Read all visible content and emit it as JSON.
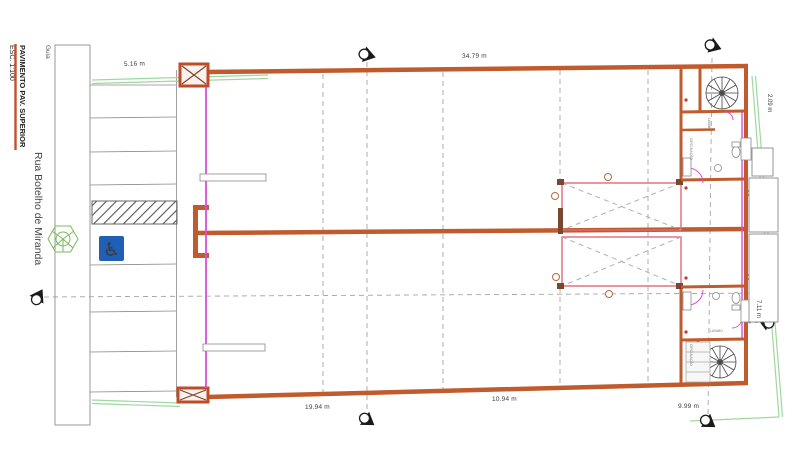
{
  "drawing": {
    "title": "PAVIMENTO PAV. SUPERIOR",
    "scale": "ESC. 1:100",
    "street_name": "Rua Botelho de Miranda",
    "curb_label": "Guia"
  },
  "dimensions": {
    "front_setback": "5.16 m",
    "top_width": "34.79 m",
    "right_setback": "2.09 m",
    "bottom_left_width": "19.94 m",
    "bottom_middle_width": "10.94 m",
    "bottom_right_width": "9.99 m",
    "right_depth": "7.11 m"
  },
  "rooms": {
    "lavabo_upper": "LAVABO",
    "circulation_upper": "CIRCULAÇÃO",
    "lavabo_lower": "LAVABO",
    "circulation_lower": "CIRCULAÇÃO"
  },
  "colors": {
    "wall": "#bf5b2c",
    "boundary_green": "#9fd89f",
    "glass_magenta": "#d94fd9",
    "void_outline": "#e0697a",
    "accessible_blue": "#1f5fb4"
  }
}
